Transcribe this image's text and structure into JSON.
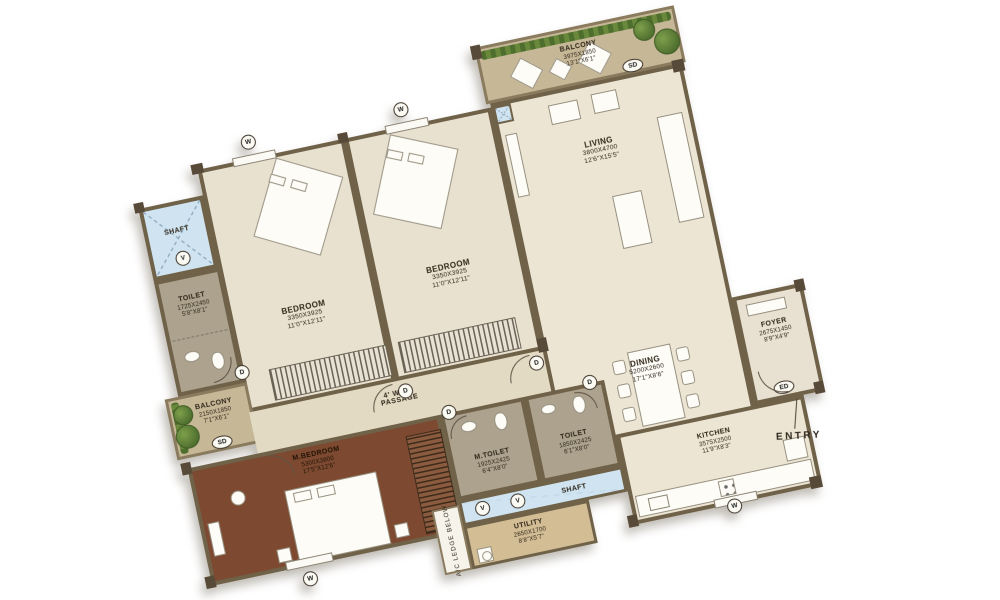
{
  "plan_title": "Apartment Floor Plan",
  "rooms": {
    "balcony_top": {
      "name": "BALCONY",
      "dims_mm": "3975X1850",
      "dims_ft": "13'1\"X6'1\""
    },
    "living": {
      "name": "LIVING",
      "dims_mm": "3800X4700",
      "dims_ft": "12'6\"X15'5\""
    },
    "bedroom_left": {
      "name": "BEDROOM",
      "dims_mm": "3350X3925",
      "dims_ft": "11'0\"X12'11\""
    },
    "bedroom_mid": {
      "name": "BEDROOM",
      "dims_mm": "3350X3925",
      "dims_ft": "11'0\"X12'11\""
    },
    "shaft_top": {
      "name": "SHAFT"
    },
    "toilet_top": {
      "name": "TOILET",
      "dims_mm": "1725X2450",
      "dims_ft": "5'8\"X8'1\""
    },
    "balcony_left": {
      "name": "BALCONY",
      "dims_mm": "2150X1850",
      "dims_ft": "7'1\"X6'1\""
    },
    "passage": {
      "name_line1": "4' WIDE",
      "name_line2": "PASSAGE"
    },
    "m_bedroom": {
      "name": "M.BEDROOM",
      "dims_mm": "5300X3800",
      "dims_ft": "17'5\"X12'6\""
    },
    "m_toilet": {
      "name": "M.TOILET",
      "dims_mm": "1925X2425",
      "dims_ft": "6'4\"X8'0\""
    },
    "toilet_common": {
      "name": "TOILET",
      "dims_mm": "1850X2425",
      "dims_ft": "6'1\"X8'0\""
    },
    "shaft_bottom": {
      "name": "SHAFT"
    },
    "utility": {
      "name": "UTILITY",
      "dims_mm": "2650X1700",
      "dims_ft": "8'8\"X5'7\""
    },
    "kitchen": {
      "name": "KITCHEN",
      "dims_mm": "3575X2500",
      "dims_ft": "11'9\"X8'3\""
    },
    "dining": {
      "name": "DINING",
      "dims_mm": "5200X2600",
      "dims_ft": "17'1\"X8'6\""
    },
    "foyer": {
      "name": "FOYER",
      "dims_mm": "2675X1450",
      "dims_ft": "8'9\"X4'9\""
    },
    "ac_ledge": {
      "name": "A/C LEDGE BELOW"
    }
  },
  "markers": {
    "window": "W",
    "door": "D",
    "vent": "V",
    "sliding_door": "SD",
    "entry_door": "ED"
  },
  "labels": {
    "entry": "ENTRY"
  },
  "colors": {
    "wall": "#6f6249",
    "floor_light": "#ece5d4",
    "floor_bedroom": "#e9e1d0",
    "floor_master": "#7d4a31",
    "floor_toilet": "#aca28e",
    "floor_balcony": "#c6b797",
    "floor_utility": "#d3bd95",
    "floor_passage": "#e3dac4",
    "shaft_blue": "#cfe3f0",
    "hedge_green": "#5a7a38"
  }
}
